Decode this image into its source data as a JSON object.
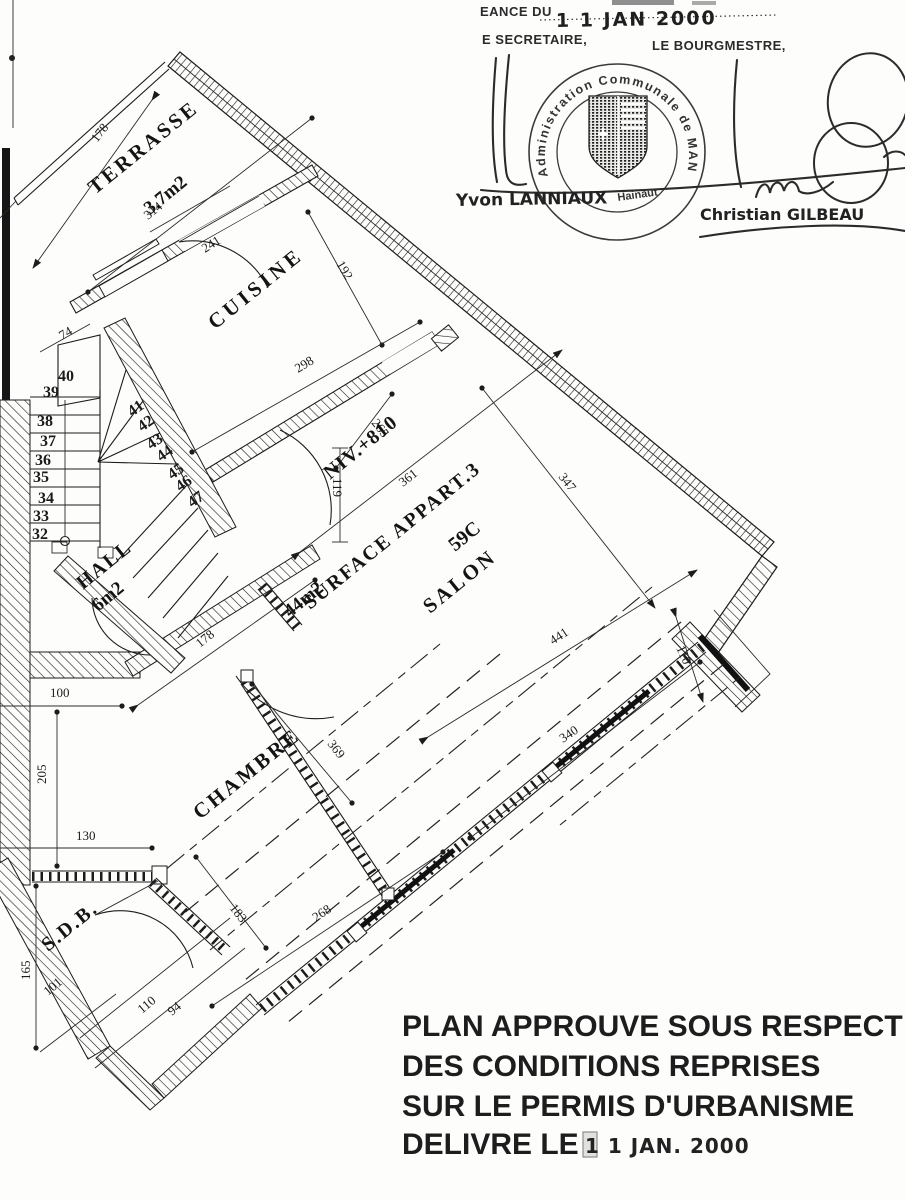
{
  "stamp": {
    "top_label": "EANCE DU",
    "top_date": "1 1 JAN 2000",
    "secretary": "E SECRETAIRE,",
    "mayor": "LE BOURGMESTRE,",
    "seal_arc": "Administration Communale de MANAGE",
    "seal_bottom": "Hainaut",
    "signer_left": "Yvon LANNIAUX",
    "signer_right": "Christian GILBEAU"
  },
  "approval": {
    "line1": "PLAN APPROUVE SOUS RESPECT",
    "line2": "DES CONDITIONS REPRISES",
    "line3": "SUR LE PERMIS D'URBANISME",
    "line4": "DELIVRE LE",
    "date": "1 1 JAN. 2000"
  },
  "plan": {
    "level": "NIV.+810",
    "rooms": {
      "terrasse": "TERRASSE",
      "terrasse_area": "3.7m2",
      "cuisine": "CUISINE",
      "hall": "HALL",
      "hall_area": "6m2",
      "salon": "SALON",
      "chambre": "CHAMBRE",
      "sdb": "S.D.B."
    },
    "surface": {
      "label": "SURFACE APPART.3",
      "code": "59C",
      "area": "44m2"
    },
    "dims": {
      "terrace_len": "178",
      "terrace_width": "314",
      "kitchen_door": "241",
      "kitchen_width": "192",
      "kitchen_len": "298",
      "landing": "74",
      "niv_offset": "265",
      "salon_width": "361",
      "salon_diag": "347",
      "hall_len": "178",
      "hall_opening": "100",
      "side_upper": "205",
      "side_lower": "130",
      "divider": "369",
      "salon_len": "441",
      "corner": "110",
      "salon_window": "340",
      "chambre_window": "268",
      "chambre_gap": "183",
      "sdb_side": "165",
      "sdb_bottom": "101",
      "sdb_door": "110",
      "sdb_door_b": "94",
      "niv_door": "119"
    },
    "steps": [
      "32",
      "33",
      "34",
      "35",
      "36",
      "37",
      "38",
      "39",
      "40",
      "41",
      "42",
      "43",
      "44",
      "45",
      "46",
      "47"
    ]
  }
}
